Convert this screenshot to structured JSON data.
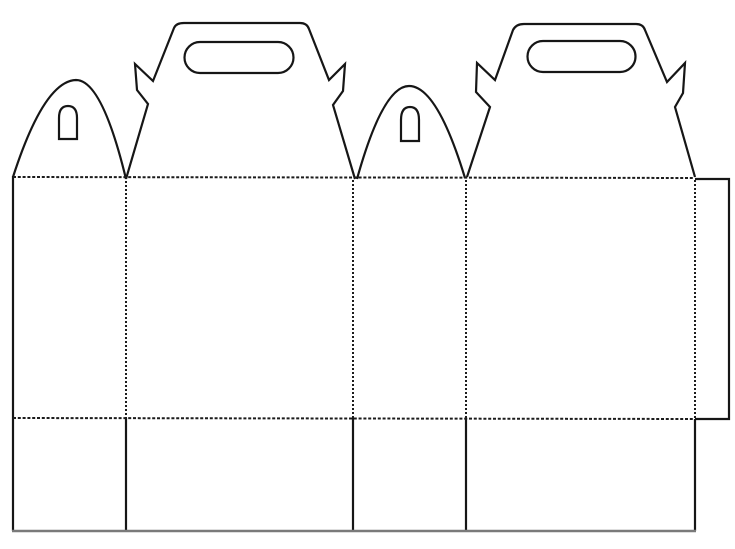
{
  "canvas": {
    "width": 735,
    "height": 549,
    "background": "#ffffff"
  },
  "palette": {
    "cut_line": "#161616",
    "fold_line": "#1c1c1c",
    "bottom_edge_line": "#7a7a7a",
    "paper": "#ffffff"
  },
  "line_styles": {
    "cut": {
      "width": 2.2,
      "dash": "none"
    },
    "cut_soft": {
      "width": 2.4,
      "dash": "none"
    },
    "fold_h": {
      "width": 2.0,
      "dash": "3,1.8"
    },
    "fold_v": {
      "width": 2.0,
      "dash": "2,2"
    }
  },
  "diagram": {
    "title": "gable-box-papercraft-template",
    "shapes": [
      {
        "name": "left-side-cut-edge",
        "kind": "cut",
        "style": "cut",
        "color_key": "cut_line",
        "path": "M 13 176 L 13 531"
      },
      {
        "name": "small-arch-1-outline",
        "kind": "cut",
        "style": "cut",
        "color_key": "cut_line",
        "path": "M 13 177 Q 44 81 76 80 Q 102 80 126 179"
      },
      {
        "name": "small-arch-1-slot-cutout",
        "kind": "cut",
        "style": "cut",
        "color_key": "cut_line",
        "path": "M 59 139 L 59 118 Q 59 106 68 106 Q 77 106 77 118 L 77 139 Z"
      },
      {
        "name": "gable-handle-1-outline",
        "kind": "cut",
        "style": "cut",
        "color_key": "cut_line",
        "path": "M 126 179 L 148 104 L 137 90 L 135 64 L 153 81 L 174 28 Q 176 23 184 23 L 300 23 Q 307 23 309 29 L 329 80 L 345 64 L 343 91 L 333 105 L 355 179"
      },
      {
        "name": "gable-handle-1-grip-cutout",
        "kind": "cut",
        "style": "cut",
        "color_key": "cut_line",
        "path": "M 200 42 L 278 42 A 15.5 15.5 0 0 1 278 73 L 200 73 A 15.5 15.5 0 0 1 200 42 Z"
      },
      {
        "name": "small-arch-2-outline",
        "kind": "cut",
        "style": "cut",
        "color_key": "cut_line",
        "path": "M 357 179 Q 383 86 409 86 Q 437 86 465 178"
      },
      {
        "name": "small-arch-2-slot-cutout",
        "kind": "cut",
        "style": "cut",
        "color_key": "cut_line",
        "path": "M 401 141 L 401 120 Q 401 107 410 107 Q 419 107 419 120 L 419 141 Z"
      },
      {
        "name": "gable-handle-2-outline",
        "kind": "cut",
        "style": "cut",
        "color_key": "cut_line",
        "path": "M 467 177 L 490 107 L 476 92 L 477 63 L 495 80 L 513 30 Q 516 24 524 24 L 636 24 Q 643 24 645 30 L 667 82 L 685 63 L 683 93 L 675 107 L 695 177"
      },
      {
        "name": "gable-handle-2-grip-cutout",
        "kind": "cut",
        "style": "cut",
        "color_key": "cut_line",
        "path": "M 543 41 L 620 41 A 15.5 15.5 0 0 1 620 72 L 543 72 A 15.5 15.5 0 0 1 543 41 Z"
      },
      {
        "name": "glue-tab-cut-edge",
        "kind": "cut",
        "style": "cut",
        "color_key": "cut_line",
        "path": "M 695 179 L 729 179 L 729 419 L 695 419"
      },
      {
        "name": "bottom-flap-divider-1",
        "kind": "cut",
        "style": "cut",
        "color_key": "cut_line",
        "path": "M 126 418 L 126 531"
      },
      {
        "name": "bottom-flap-divider-2",
        "kind": "cut",
        "style": "cut",
        "color_key": "cut_line",
        "path": "M 353 418 L 353 531"
      },
      {
        "name": "bottom-flap-divider-3",
        "kind": "cut",
        "style": "cut",
        "color_key": "cut_line",
        "path": "M 466 418 L 466 531"
      },
      {
        "name": "bottom-flap-right-edge",
        "kind": "cut",
        "style": "cut",
        "color_key": "cut_line",
        "path": "M 695 419 L 695 531"
      },
      {
        "name": "bottom-cut-edge",
        "kind": "cut",
        "style": "cut_soft",
        "color_key": "bottom_edge_line",
        "path": "M 12 531 L 696 531"
      },
      {
        "name": "top-fold-line",
        "kind": "fold",
        "style": "fold_h",
        "color_key": "fold_line",
        "path": "M 13 177 L 694 178"
      },
      {
        "name": "middle-fold-line",
        "kind": "fold",
        "style": "fold_h",
        "color_key": "fold_line",
        "path": "M 13 418 L 693 419"
      },
      {
        "name": "panel-fold-line-1",
        "kind": "fold",
        "style": "fold_v",
        "color_key": "fold_line",
        "path": "M 126 181 L 126 418"
      },
      {
        "name": "panel-fold-line-2",
        "kind": "fold",
        "style": "fold_v",
        "color_key": "fold_line",
        "path": "M 353 180 L 353 418"
      },
      {
        "name": "panel-fold-line-3",
        "kind": "fold",
        "style": "fold_v",
        "color_key": "fold_line",
        "path": "M 466 180 L 466 418"
      },
      {
        "name": "glue-tab-fold-line",
        "kind": "fold",
        "style": "fold_v",
        "color_key": "fold_line",
        "path": "M 695 180 L 695 418"
      }
    ]
  }
}
